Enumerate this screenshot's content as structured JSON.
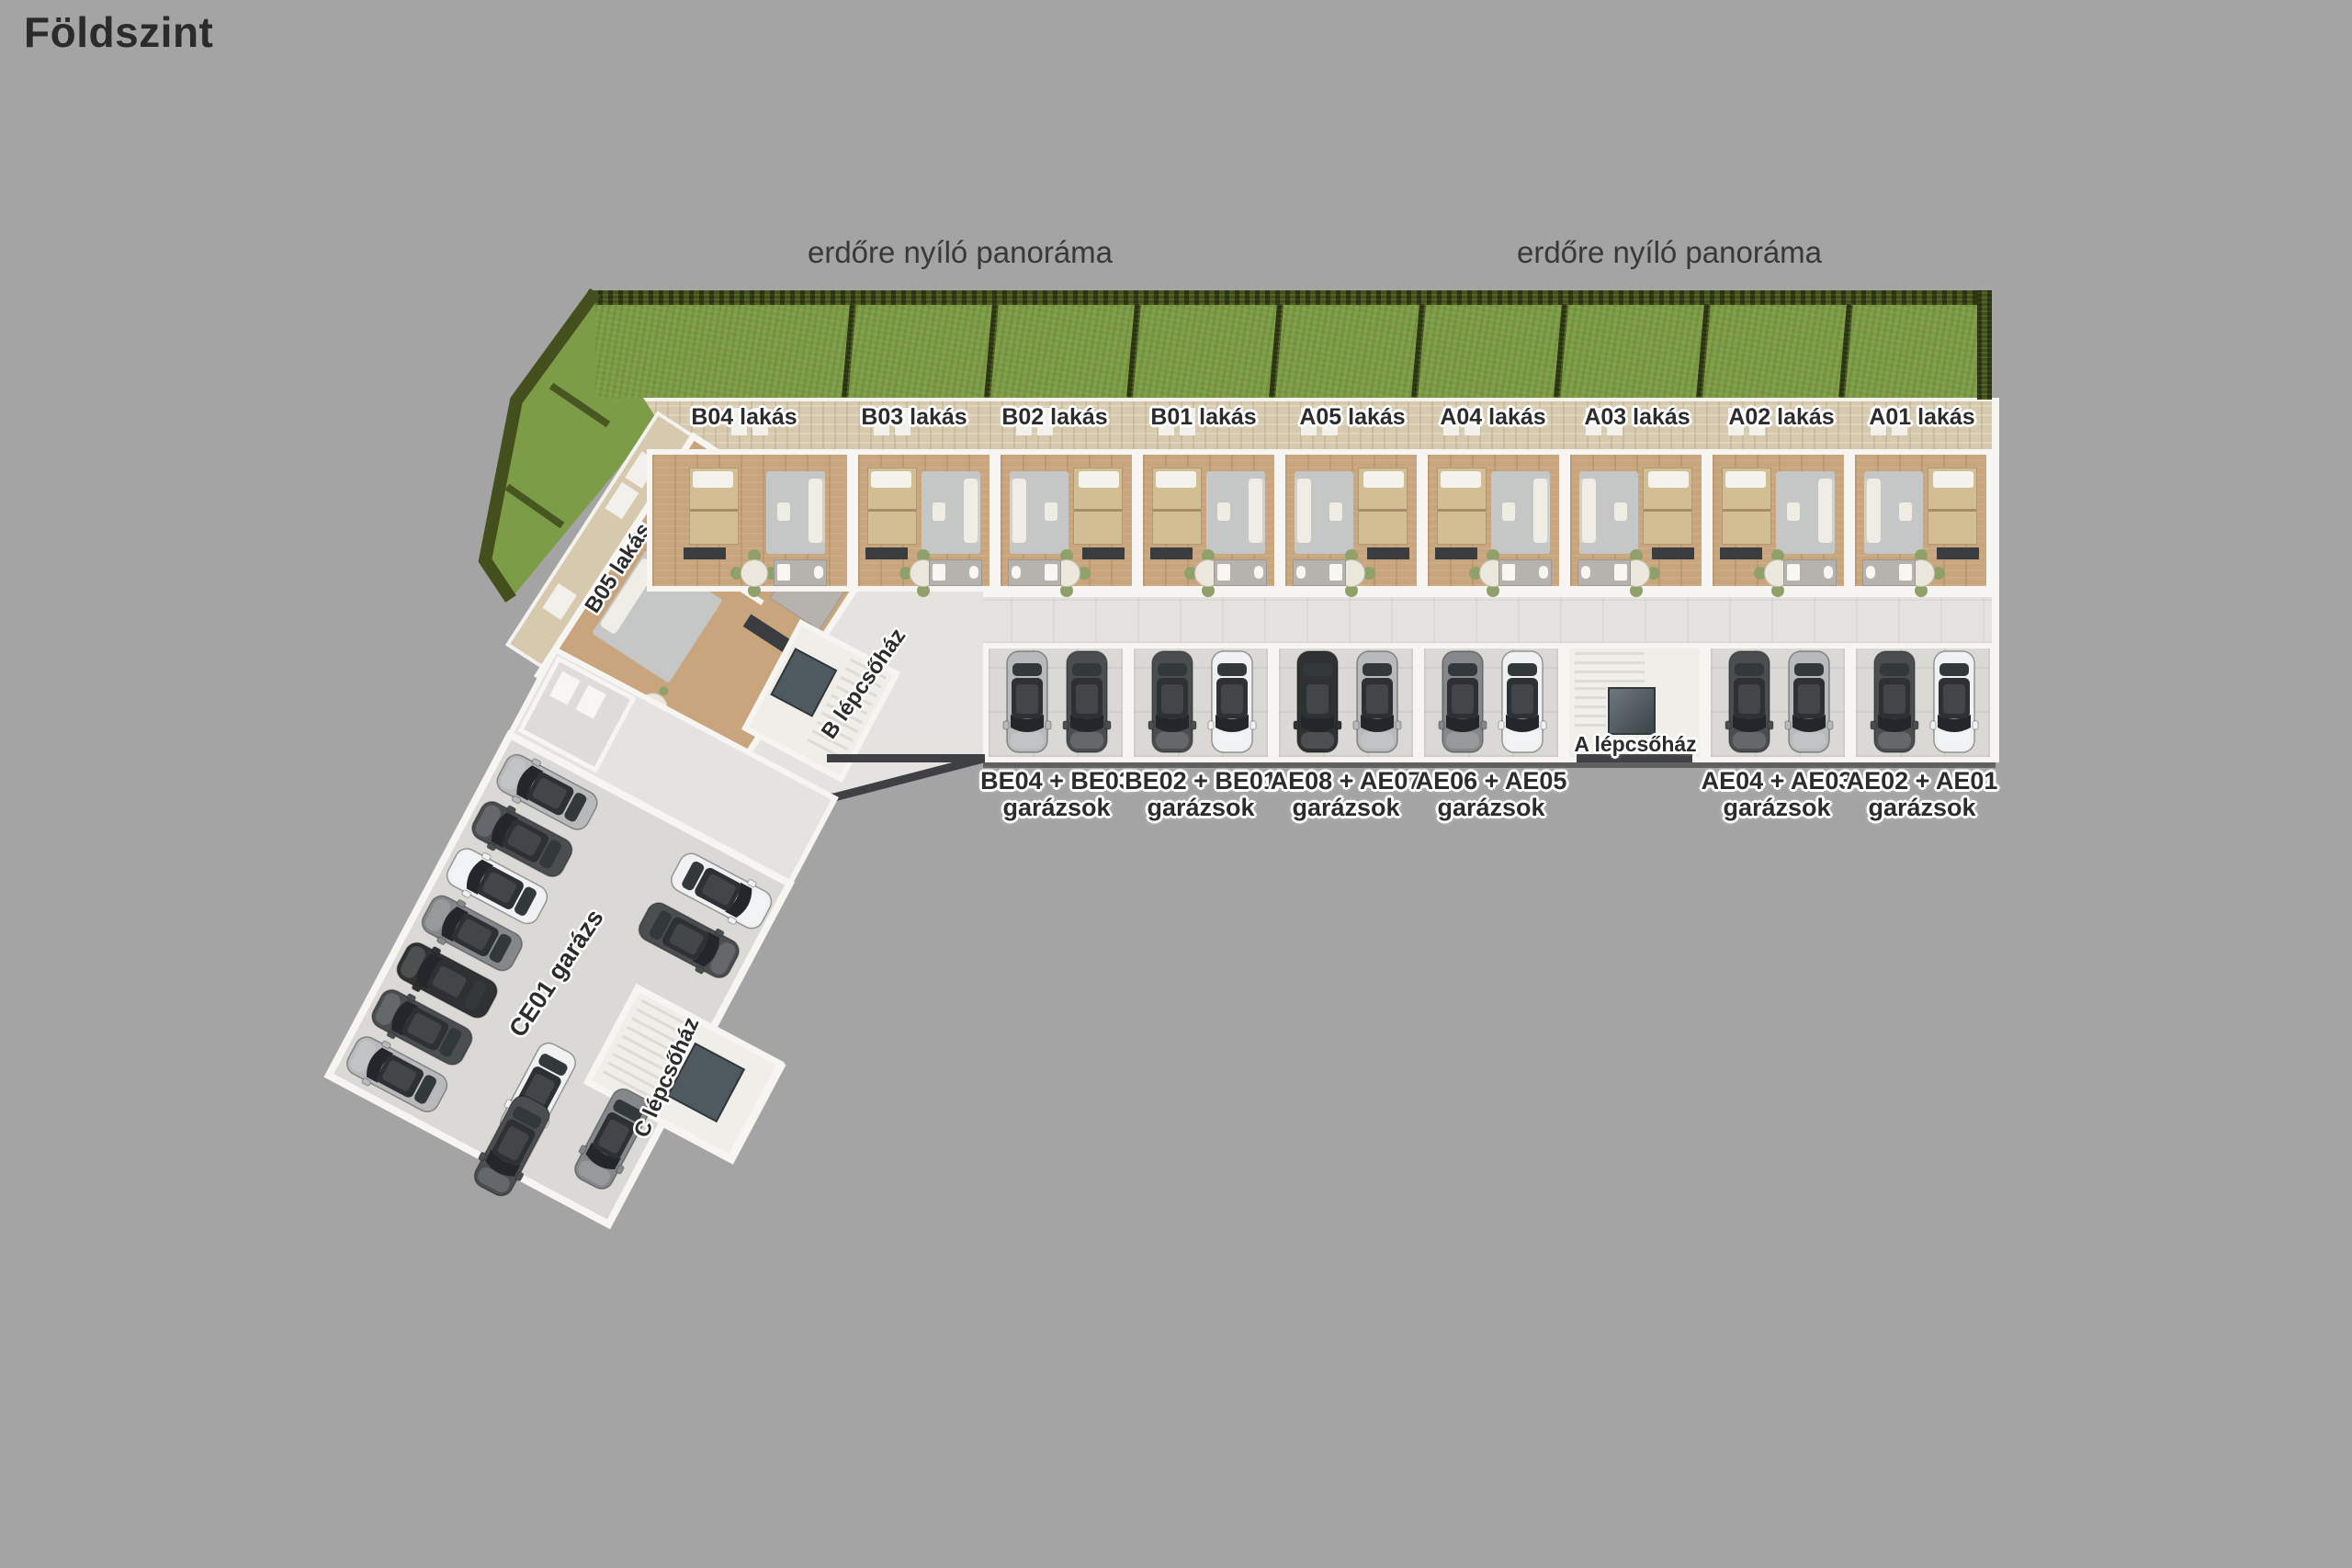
{
  "title": "Földszint",
  "panorama": {
    "left": "erdőre nyíló panoráma",
    "right": "erdőre nyíló panoráma"
  },
  "apartments": {
    "units": [
      {
        "label": "B04 lakás"
      },
      {
        "label": "B03 lakás"
      },
      {
        "label": "B02 lakás"
      },
      {
        "label": "B01 lakás"
      },
      {
        "label": "A05 lakás"
      },
      {
        "label": "A04 lakás"
      },
      {
        "label": "A03 lakás"
      },
      {
        "label": "A02 lakás"
      },
      {
        "label": "A01 lakás"
      }
    ],
    "corner_unit": {
      "label": "B05 lakás"
    }
  },
  "garages": {
    "boxes": [
      {
        "name": "BE04 + BE03",
        "type": "garázsok"
      },
      {
        "name": "BE02 + BE01",
        "type": "garázsok"
      },
      {
        "name": "AE08 + AE07",
        "type": "garázsok"
      },
      {
        "name": "AE06 + AE05",
        "type": "garázsok"
      },
      {
        "name": "AE04 + AE03",
        "type": "garázsok"
      },
      {
        "name": "AE02 + AE01",
        "type": "garázsok"
      }
    ],
    "large_garage": {
      "label": "CE01 garázs"
    }
  },
  "staircases": {
    "a": {
      "label": "A lépcsőház"
    },
    "b": {
      "label": "B lépcsőház"
    },
    "c": {
      "label": "C lépcsőház"
    }
  },
  "cars": {
    "garage_row_pairs": [
      [
        "silver",
        "dark-gray"
      ],
      [
        "dark-gray",
        "white"
      ],
      [
        "black",
        "silver"
      ],
      [
        "gray",
        "white"
      ],
      [
        "dark-gray",
        "silver"
      ],
      [
        "dark-gray",
        "white"
      ]
    ],
    "ce01_left_wall": [
      "silver",
      "dark-gray",
      "white",
      "gray",
      "black",
      "dark-gray",
      "silver"
    ],
    "ce01_right_side": [
      "white",
      "dark-gray"
    ],
    "ce01_lower_group": [
      "white",
      "dark-gray",
      "gray"
    ]
  },
  "colors": {
    "background": "#a4a4a4",
    "grass": "#7d9c47",
    "hedge": "#43501e",
    "terrace": "#d6c9ad",
    "wood_floor": "#c8a57c",
    "wall": "#f6f5f1",
    "corridor_floor": "#e4e3df",
    "garage_floor": "#dad9d5",
    "tile_gray": "#b6b3ae",
    "elevator": "#4e5a60",
    "label_text": "#2c2c2c"
  }
}
